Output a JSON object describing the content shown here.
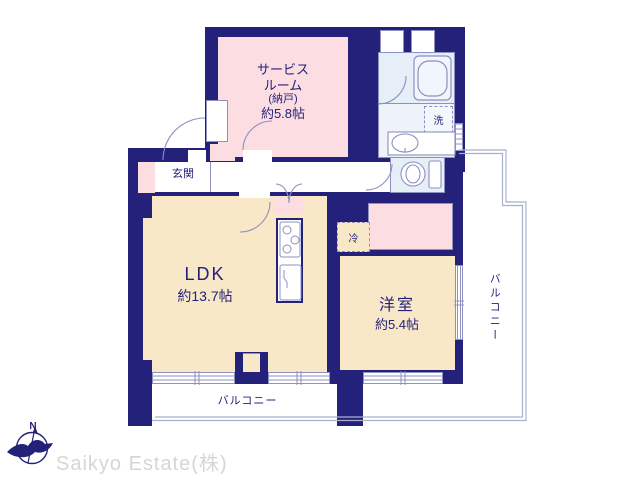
{
  "branding": {
    "logo_text": "Saikyo Estate(株)",
    "compass_label": "N"
  },
  "rooms": {
    "service_room": {
      "name_line1": "サービス",
      "name_line2": "ルーム",
      "name_line3": "(納戸)",
      "size": "約5.8帖"
    },
    "entrance": {
      "label": "玄関"
    },
    "ldk": {
      "label": "LDK",
      "size": "約13.7帖"
    },
    "western_room": {
      "label": "洋室",
      "size": "約5.4帖"
    },
    "balcony_south": {
      "label": "バルコニー"
    },
    "balcony_east": {
      "label": "バルコニー"
    }
  },
  "fixtures": {
    "washer": {
      "label": "洗"
    },
    "refrigerator": {
      "label": "冷"
    }
  },
  "colors": {
    "wall": "#24217b",
    "room_cream": "#f8e8c7",
    "room_pink": "#fbdde2",
    "bath_blue": "#e6eef8",
    "powder_blue": "#eef3fa",
    "line": "#8d90c0",
    "balcony_line": "#a9b0ca",
    "text": "#24217b",
    "logo_gray": "#d6d6d6",
    "bg": "#ffffff"
  }
}
